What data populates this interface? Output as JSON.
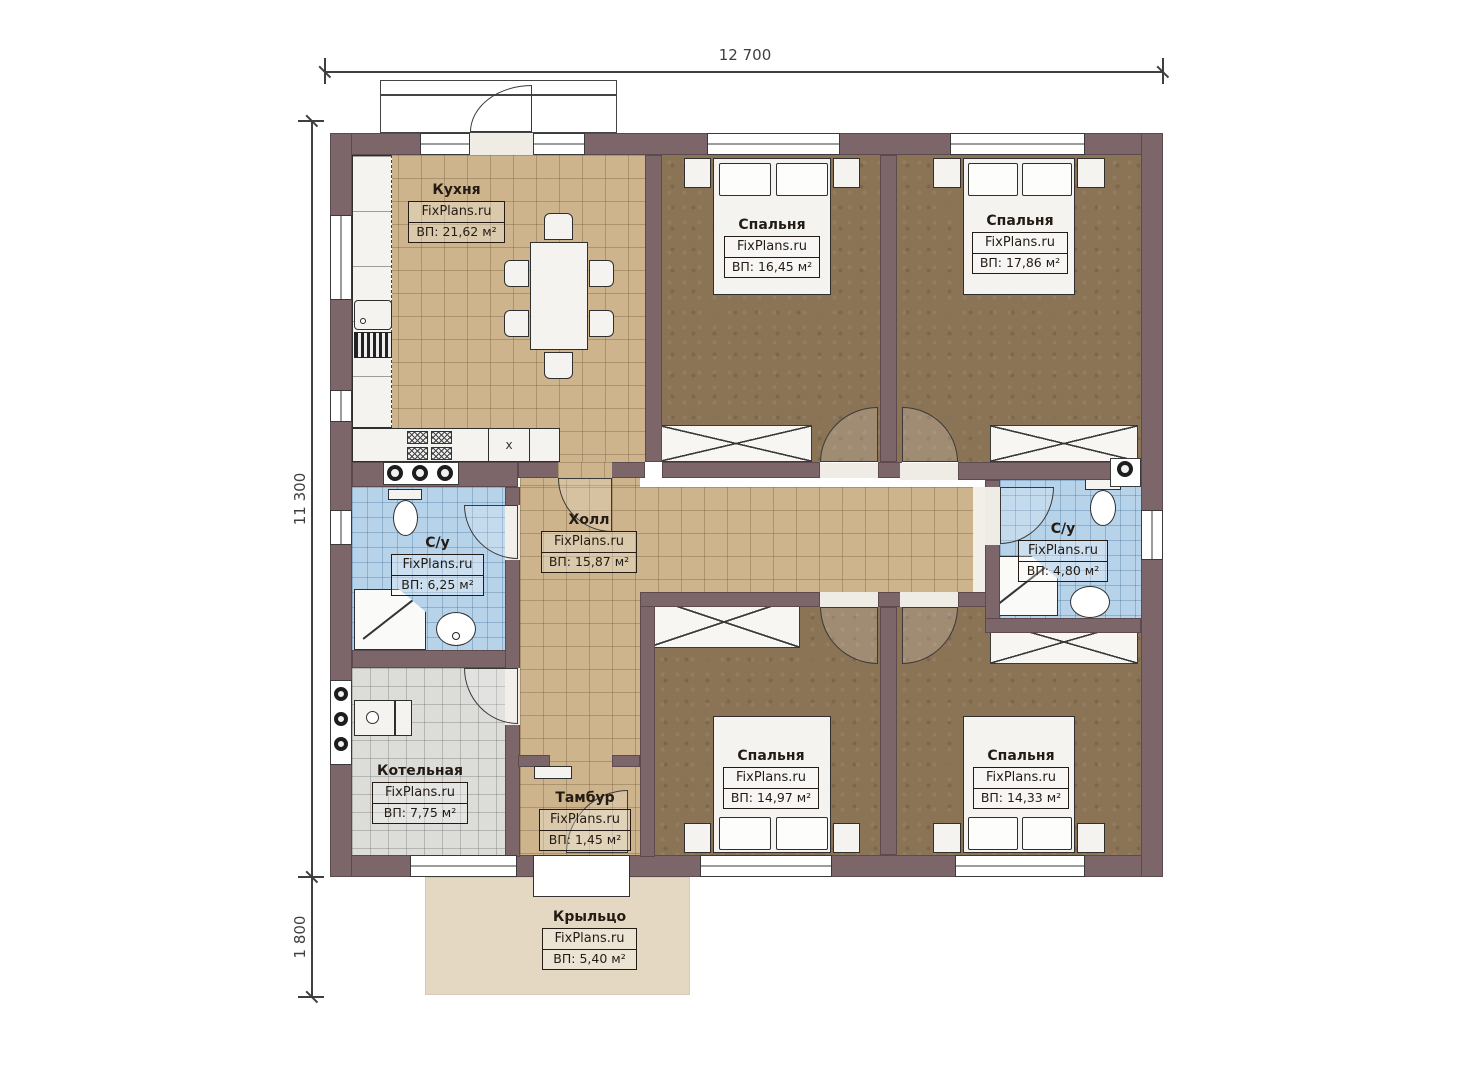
{
  "plan": {
    "watermark": "FixPlans.ru",
    "dimensions": {
      "overall_width": "12 700",
      "overall_height": "11 300",
      "porch_depth": "1 800"
    },
    "rooms": {
      "kitchen": {
        "name": "Кухня",
        "brand": "FixPlans.ru",
        "area": "ВП: 21,62 м²"
      },
      "bedroom1": {
        "name": "Спальня",
        "brand": "FixPlans.ru",
        "area": "ВП: 16,45 м²"
      },
      "bedroom2": {
        "name": "Спальня",
        "brand": "FixPlans.ru",
        "area": "ВП: 17,86 м²"
      },
      "bath1": {
        "name": "С/у",
        "brand": "FixPlans.ru",
        "area": "ВП: 6,25 м²"
      },
      "hall": {
        "name": "Холл",
        "brand": "FixPlans.ru",
        "area": "ВП: 15,87 м²"
      },
      "bath2": {
        "name": "С/у",
        "brand": "FixPlans.ru",
        "area": "ВП: 4,80 м²"
      },
      "boiler": {
        "name": "Котельная",
        "brand": "FixPlans.ru",
        "area": "ВП: 7,75 м²"
      },
      "vestibule": {
        "name": "Тамбур",
        "brand": "FixPlans.ru",
        "area": "ВП: 1,45 м²"
      },
      "bedroom3": {
        "name": "Спальня",
        "brand": "FixPlans.ru",
        "area": "ВП: 14,97 м²"
      },
      "bedroom4": {
        "name": "Спальня",
        "brand": "FixPlans.ru",
        "area": "ВП: 14,33 м²"
      },
      "porch": {
        "name": "Крыльцо",
        "brand": "FixPlans.ru",
        "area": "ВП: 5,40 м²"
      }
    },
    "markers": {
      "kitchen_extract": "x"
    },
    "colors": {
      "wall": "#7d666a",
      "kitchen_hall_floor": "#cdb48c",
      "bedroom_floor": "#8b7355",
      "bathroom_floor": "#b7d3ea",
      "boiler_floor": "#dcdcd9",
      "porch": "#e4d8c2"
    }
  }
}
